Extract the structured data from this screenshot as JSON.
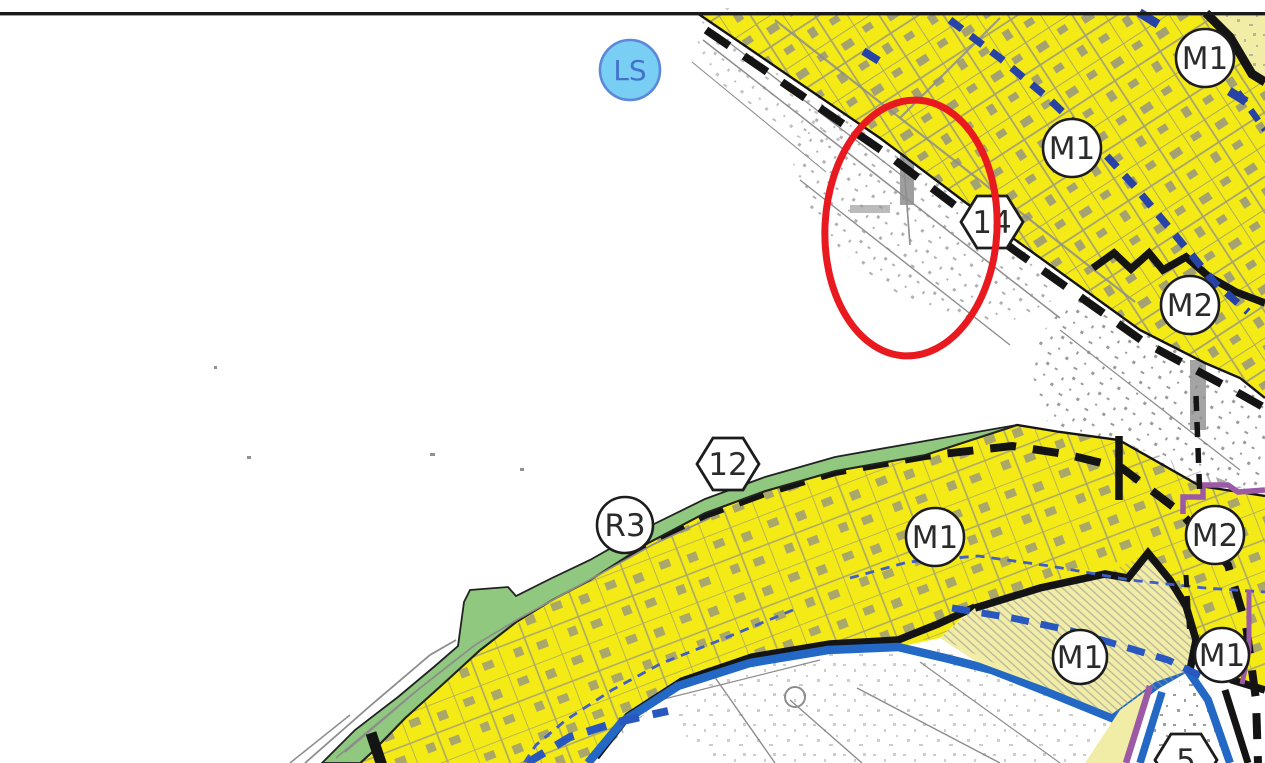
{
  "map": {
    "markers": {
      "circles": [
        {
          "label": "LS"
        },
        {
          "label": "M1"
        },
        {
          "label": "M1"
        },
        {
          "label": "M2"
        },
        {
          "label": "R3"
        },
        {
          "label": "M1"
        },
        {
          "label": "M1"
        },
        {
          "label": "M1"
        },
        {
          "label": "M2"
        }
      ],
      "hexagons": [
        {
          "label": "14"
        },
        {
          "label": "12"
        },
        {
          "label": "5"
        }
      ]
    },
    "colors": {
      "zone_yellow": "#f4ea15",
      "zone_pale_yellow": "#f2eda6",
      "zone_green": "#8fc87e",
      "ls_circle_fill": "#79cef3",
      "ls_circle_stroke": "#5d87d8",
      "water_blue": "#2268c4",
      "navy_dash_blue": "#2843a8",
      "thin_dash_blue": "#3f5ec9",
      "boundary_purple": "#9c59a6",
      "annotation_red": "#e8191f",
      "detail_gray": "#8d8d8d",
      "line_black": "#141414"
    }
  }
}
